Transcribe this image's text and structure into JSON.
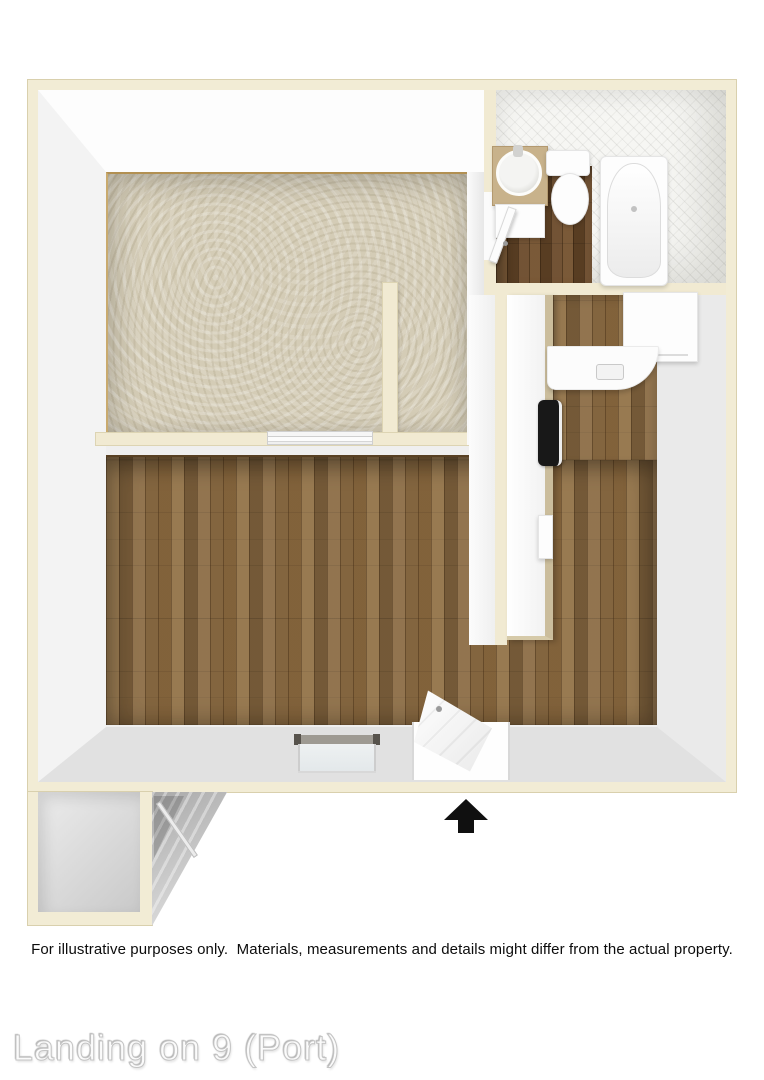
{
  "disclaimer": {
    "text": "For illustrative purposes only.  Materials, measurements and details might differ from the actual property."
  },
  "watermark": {
    "text": "Landing on 9 (Port)"
  },
  "floorplan": {
    "type": "3d-floor-plan-top-view",
    "entry_marker": "black-up-arrow",
    "rooms": [
      {
        "name": "bedroom",
        "floor": "carpet"
      },
      {
        "name": "closet",
        "floor": "carpet"
      },
      {
        "name": "bathroom",
        "floor": "dark-wood",
        "fixtures": [
          "vanity-sink",
          "toilet",
          "bathtub",
          "swing-door"
        ]
      },
      {
        "name": "kitchen",
        "floor": "wood",
        "fixtures": [
          "counter-run",
          "stove",
          "refrigerator",
          "sink-counter"
        ]
      },
      {
        "name": "living-room",
        "floor": "wood",
        "fixtures": [
          "window",
          "entry-door"
        ]
      },
      {
        "name": "exterior-landing",
        "fixtures": [
          "storage-nook",
          "staircase",
          "railing"
        ]
      }
    ],
    "colors": {
      "wall_cream": "#f2ecd5",
      "wall_outline": "#d9d0ad",
      "wall_white": "#fdfdfd",
      "carpet": "#d4ccb6",
      "wood": "#8a6a42",
      "wood_dark": "#6b4a2a",
      "tile": "#f6f6f3",
      "counter_tan": "#cbbd9c",
      "stairs_gray": "#bdbdbd",
      "arrow": "#101010",
      "stove": "#181818"
    }
  }
}
